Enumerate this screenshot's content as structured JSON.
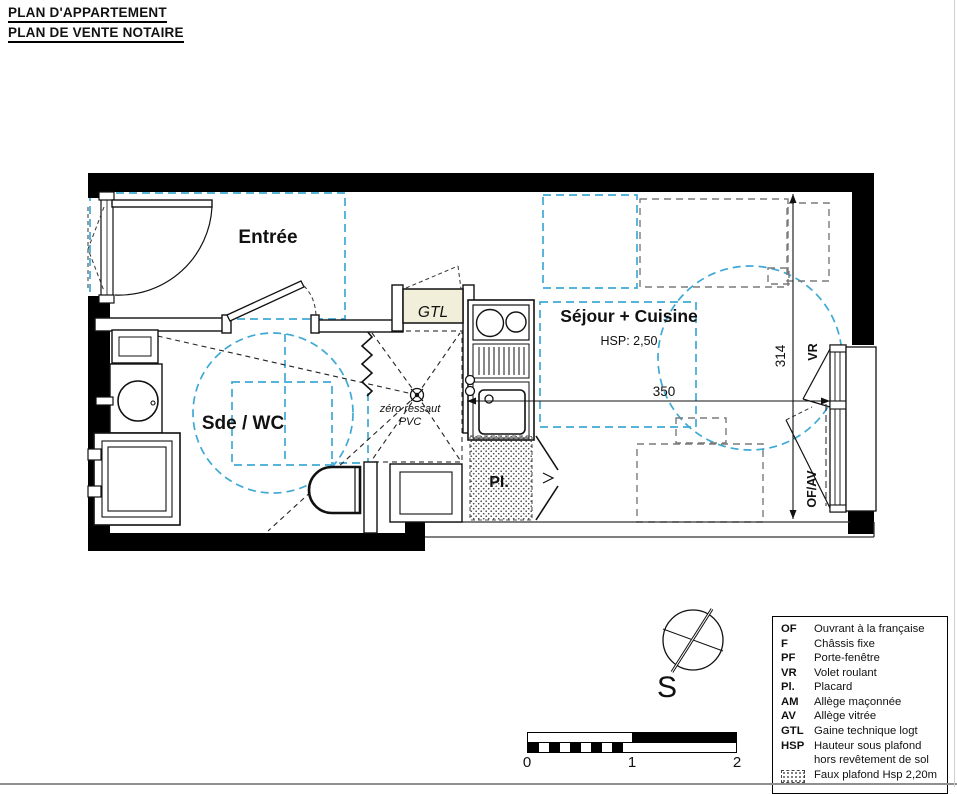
{
  "title": {
    "line1": "PLAN D'APPARTEMENT",
    "line2": "PLAN DE VENTE NOTAIRE"
  },
  "plan": {
    "rooms": {
      "entree": "Entrée",
      "sejour_cuisine": "Séjour + Cuisine",
      "sejour_hsp": "HSP: 2,50",
      "sde_wc": "Sde / WC",
      "gtl": "GTL",
      "placard": "Pl.",
      "shower_note_1": "zéro ressaut",
      "shower_note_2": "PVC"
    },
    "dimensions": {
      "horizontal": "350",
      "vertical": "314"
    },
    "window_labels": {
      "vr": "VR",
      "of_av": "OF/AV"
    }
  },
  "compass": {
    "south": "S"
  },
  "scale_bar": {
    "tick0": "0",
    "tick1": "1",
    "tick2": "2"
  },
  "legend": {
    "items": [
      {
        "abbr": "OF",
        "text": "Ouvrant à la française"
      },
      {
        "abbr": "F",
        "text": "Châssis fixe"
      },
      {
        "abbr": "PF",
        "text": "Porte-fenêtre"
      },
      {
        "abbr": "VR",
        "text": "Volet roulant"
      },
      {
        "abbr": "Pl.",
        "text": "Placard"
      },
      {
        "abbr": "AM",
        "text": "Allège maçonnée"
      },
      {
        "abbr": "AV",
        "text": "Allège vitrée"
      },
      {
        "abbr": "GTL",
        "text": "Gaine technique logt"
      },
      {
        "abbr": "HSP",
        "text": "Hauteur sous plafond hors revêtement de sol"
      }
    ],
    "hatch_text": "Faux plafond Hsp 2,20m"
  },
  "colors": {
    "wall": "#000000",
    "faux_plafond_dash": "#3FA9D5",
    "furniture_dash": "#7A7A7A",
    "gtl_fill": "#F1EED9"
  }
}
